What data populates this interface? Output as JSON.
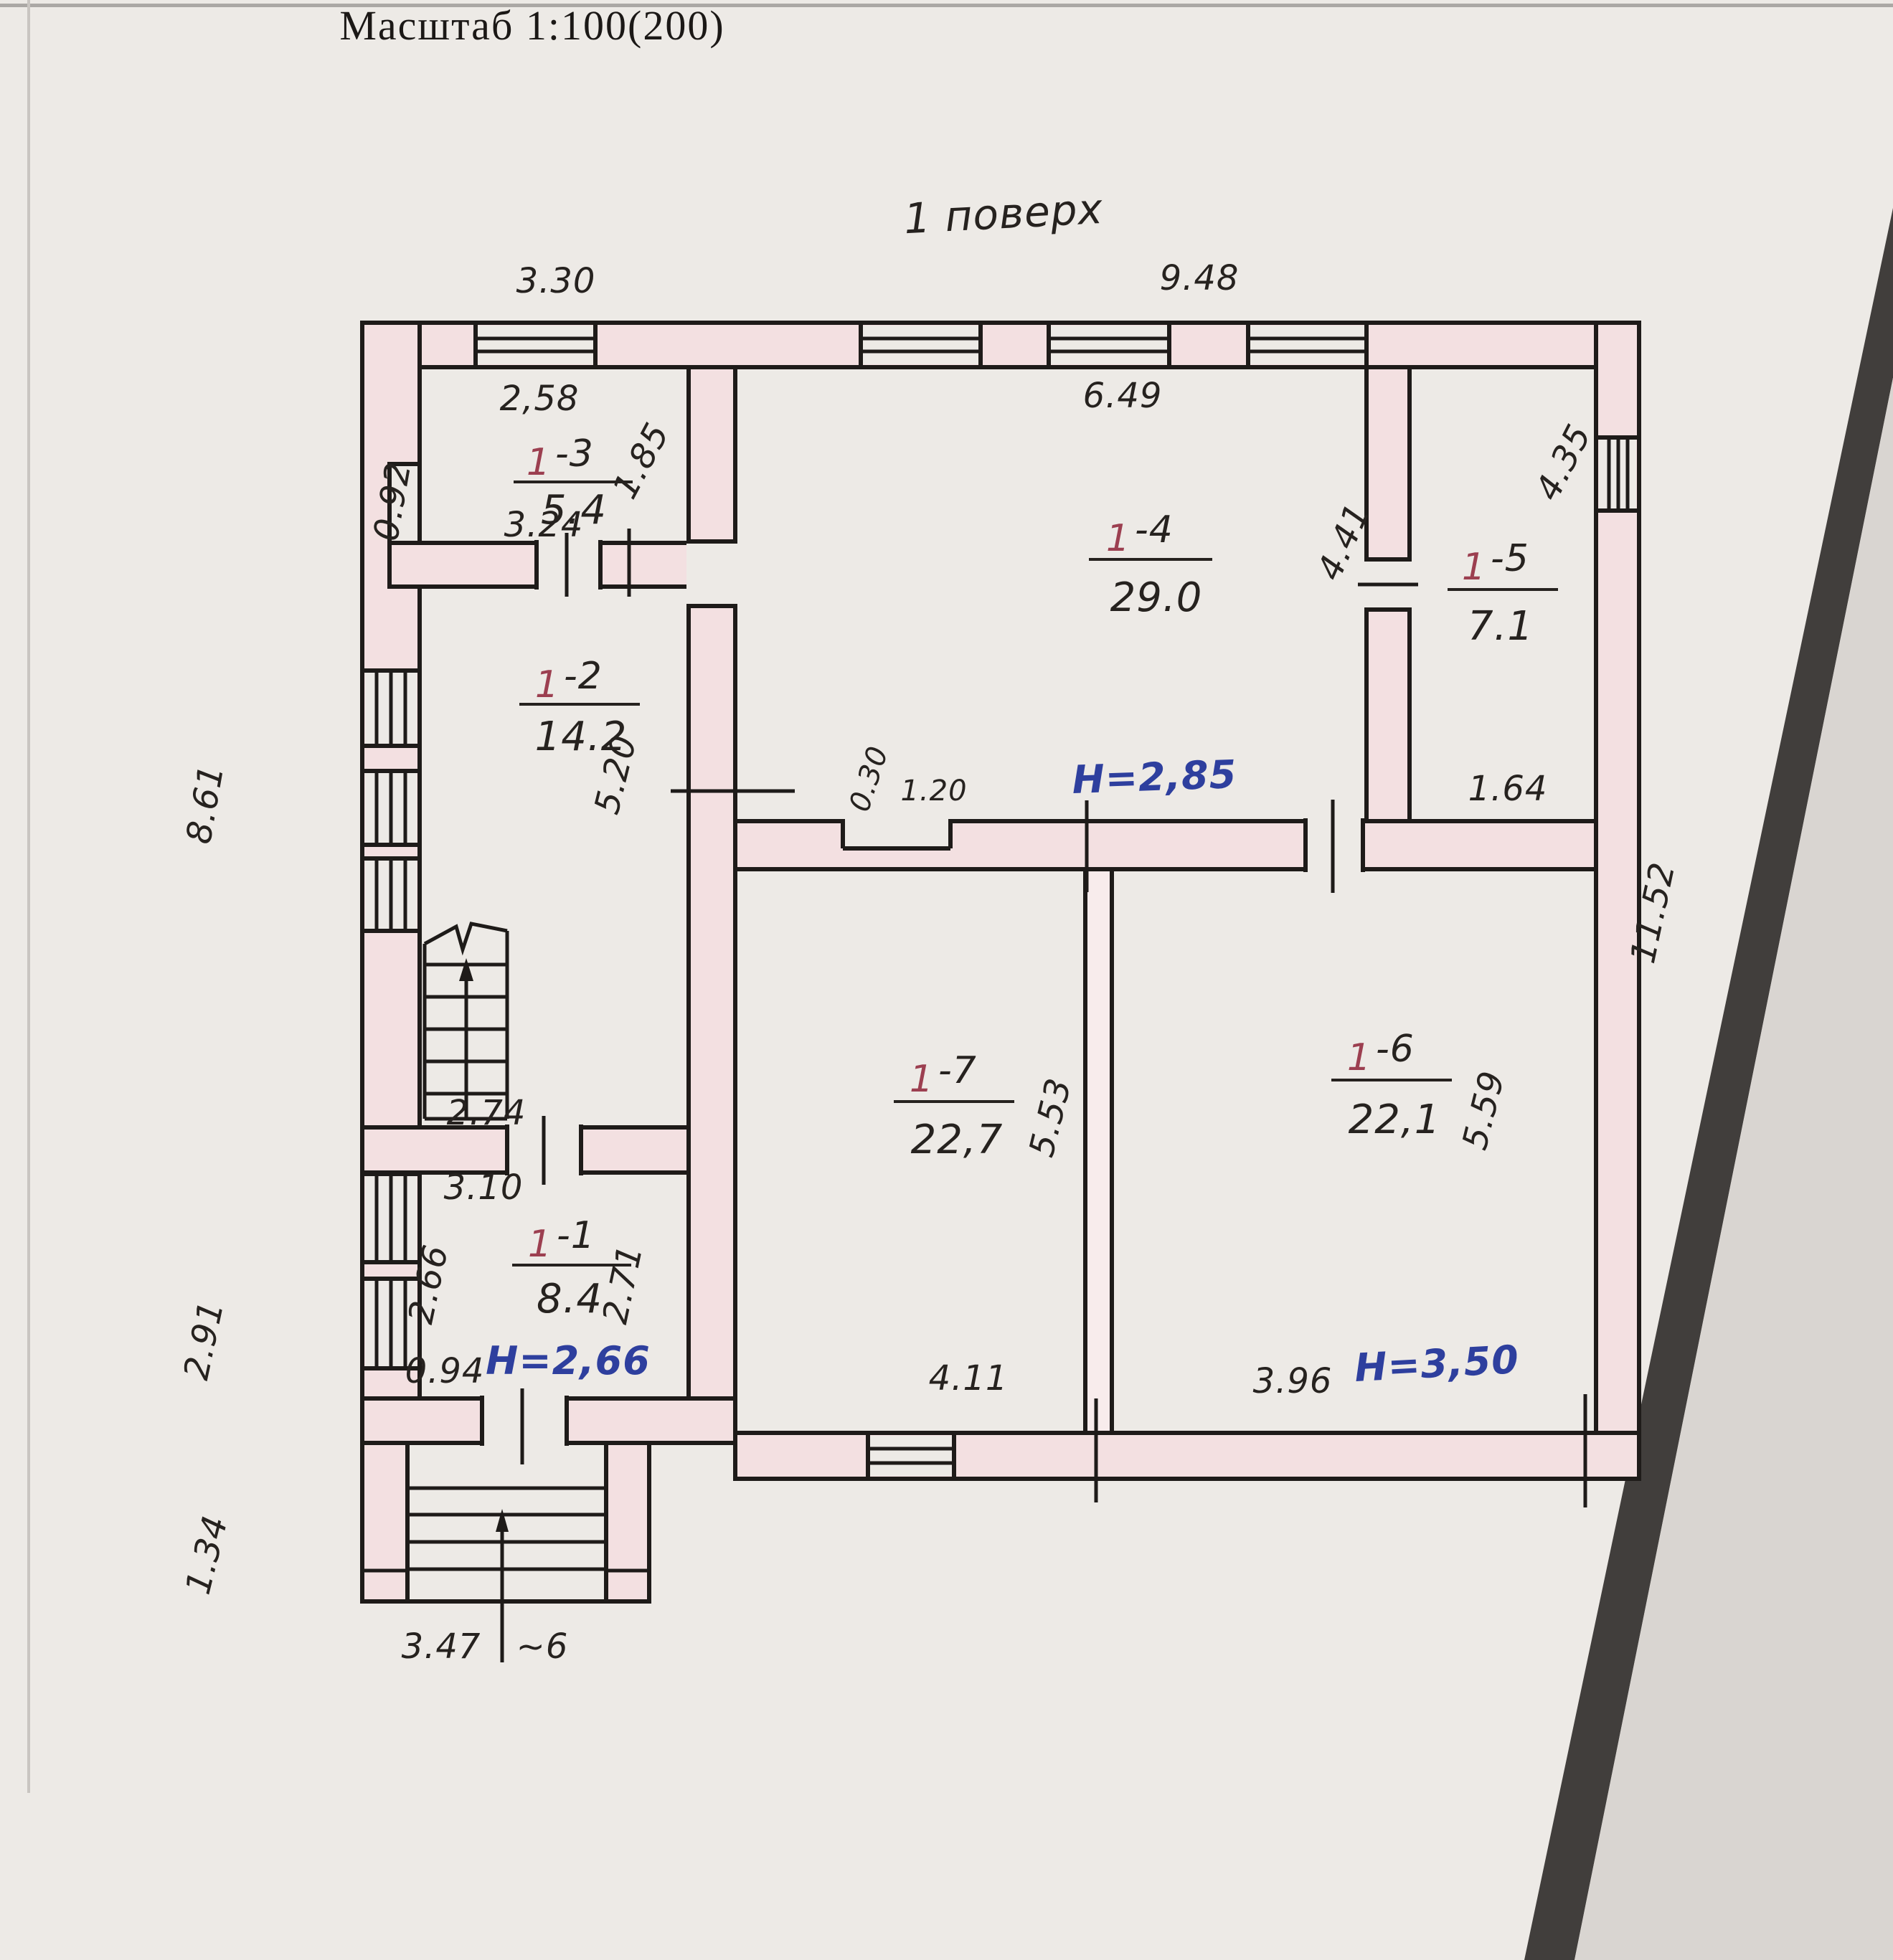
{
  "page": {
    "scale_title": "Масштаб 1:100(200)",
    "floor_title": "1 поверх"
  },
  "rooms": {
    "r11": {
      "num": "1",
      "suffix": "-1",
      "area": "8.4"
    },
    "r12": {
      "num": "1",
      "suffix": "-2",
      "area": "14.2"
    },
    "r13": {
      "num": "1",
      "suffix": "-3",
      "area": "5.4"
    },
    "r14": {
      "num": "1",
      "suffix": "-4",
      "area": "29.0"
    },
    "r15": {
      "num": "1",
      "suffix": "-5",
      "area": "7.1"
    },
    "r16": {
      "num": "1",
      "suffix": "-6",
      "area": "22,1"
    },
    "r17": {
      "num": "1",
      "suffix": "-7",
      "area": "22,7"
    }
  },
  "heights": {
    "hall": "H=2,85",
    "left": "H=2,66",
    "right": "H=3,50"
  },
  "dims": {
    "top_left": "3.30",
    "top_right": "9.48",
    "r13_top": "2,58",
    "r13_right": "1.85",
    "r13_notch": "0.92",
    "r13_bottom": "3.24",
    "r12_height": "5.20",
    "left_upper": "8.61",
    "stairs_width": "2.74",
    "r11_top": "3.10",
    "r11_left": "2.66",
    "r11_right": "2.71",
    "r11_bottom": "0.94",
    "left_lower": "2.91",
    "porch_height": "1.34",
    "porch_width": "3.47",
    "porch_steps": "~6",
    "r14_top": "6.49",
    "r14_right": "4.41",
    "niche_depth": "0.30",
    "niche_width": "1.20",
    "r15_right": "4.35",
    "r15_bottom": "1.64",
    "r17_height": "5.53",
    "r17_bottom": "4.11",
    "r16_height": "5.59",
    "r16_bottom": "3.96",
    "right_side": "11.52"
  },
  "colors": {
    "paper": "#edeae6",
    "wall_fill": "#f3e0e1",
    "ink": "#26221f",
    "room_number_red": "#9c3f50",
    "height_blue": "#2e3f9e",
    "page_edge_dark": "#413e3c"
  }
}
